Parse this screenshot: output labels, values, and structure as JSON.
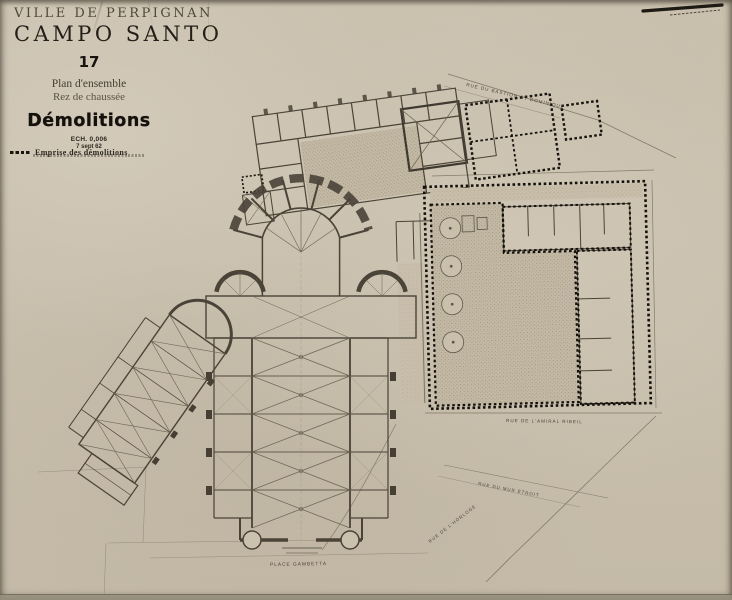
{
  "document": {
    "title_city": "VILLE DE PERPIGNAN",
    "title_main": "CAMPO SANTO",
    "sheet_number": "17",
    "subtitle_line1": "Plan d'ensemble",
    "subtitle_line2": "Rez de chaussée",
    "heading": "Démolitions",
    "scale_label": "ECH. 0,006",
    "date_label": "7 sept 62"
  },
  "legend": {
    "marker": "demolition-dotted-line",
    "label": "Emprise des démolitions"
  },
  "plan": {
    "street_labels": {
      "bastion": "RUE DU BASTION ST DOMINIQUE",
      "amiral": "RUE DE L'AMIRAL RIBEIL",
      "mur": "RUE DU MUR ÉTROIT",
      "horloge": "RUE DE L'HORLOGE",
      "place": "PLACE GAMBETTA"
    }
  },
  "colors": {
    "paper": "#c9bfad",
    "ink": "#4a4337",
    "pencil": "#7d7464",
    "demolition_ink": "#16130e"
  }
}
